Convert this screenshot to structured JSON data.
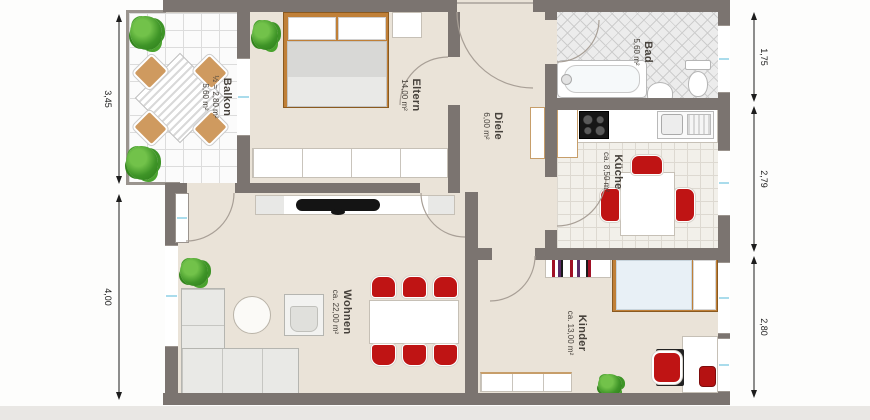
{
  "rooms": {
    "balkon": {
      "name": "Balkon",
      "area_half": "½ = 2,80 m²",
      "area": "5,60 m²"
    },
    "eltern": {
      "name": "Eltern",
      "area": "14,00 m²"
    },
    "diele": {
      "name": "Diele",
      "area": "6,00 m²"
    },
    "bad": {
      "name": "Bad",
      "area": "5,60 m²"
    },
    "kueche": {
      "name": "Küche",
      "area": "ca. 8,50 m²"
    },
    "wohnen": {
      "name": "Wohnen",
      "area": "ca. 22,00 m²"
    },
    "kinder": {
      "name": "Kinder",
      "area": "ca. 13,00 m²"
    }
  },
  "dimensions": {
    "left": [
      "3,45",
      "4,00"
    ],
    "right": [
      "1,75",
      "2,79",
      "2,80"
    ]
  },
  "colors": {
    "wall": "#7b7470",
    "floor": "#eae3d8",
    "window_glass": "#aadcec",
    "accent_red": "#bf1414",
    "wood": "#c08038",
    "plant": "#3e9427"
  }
}
